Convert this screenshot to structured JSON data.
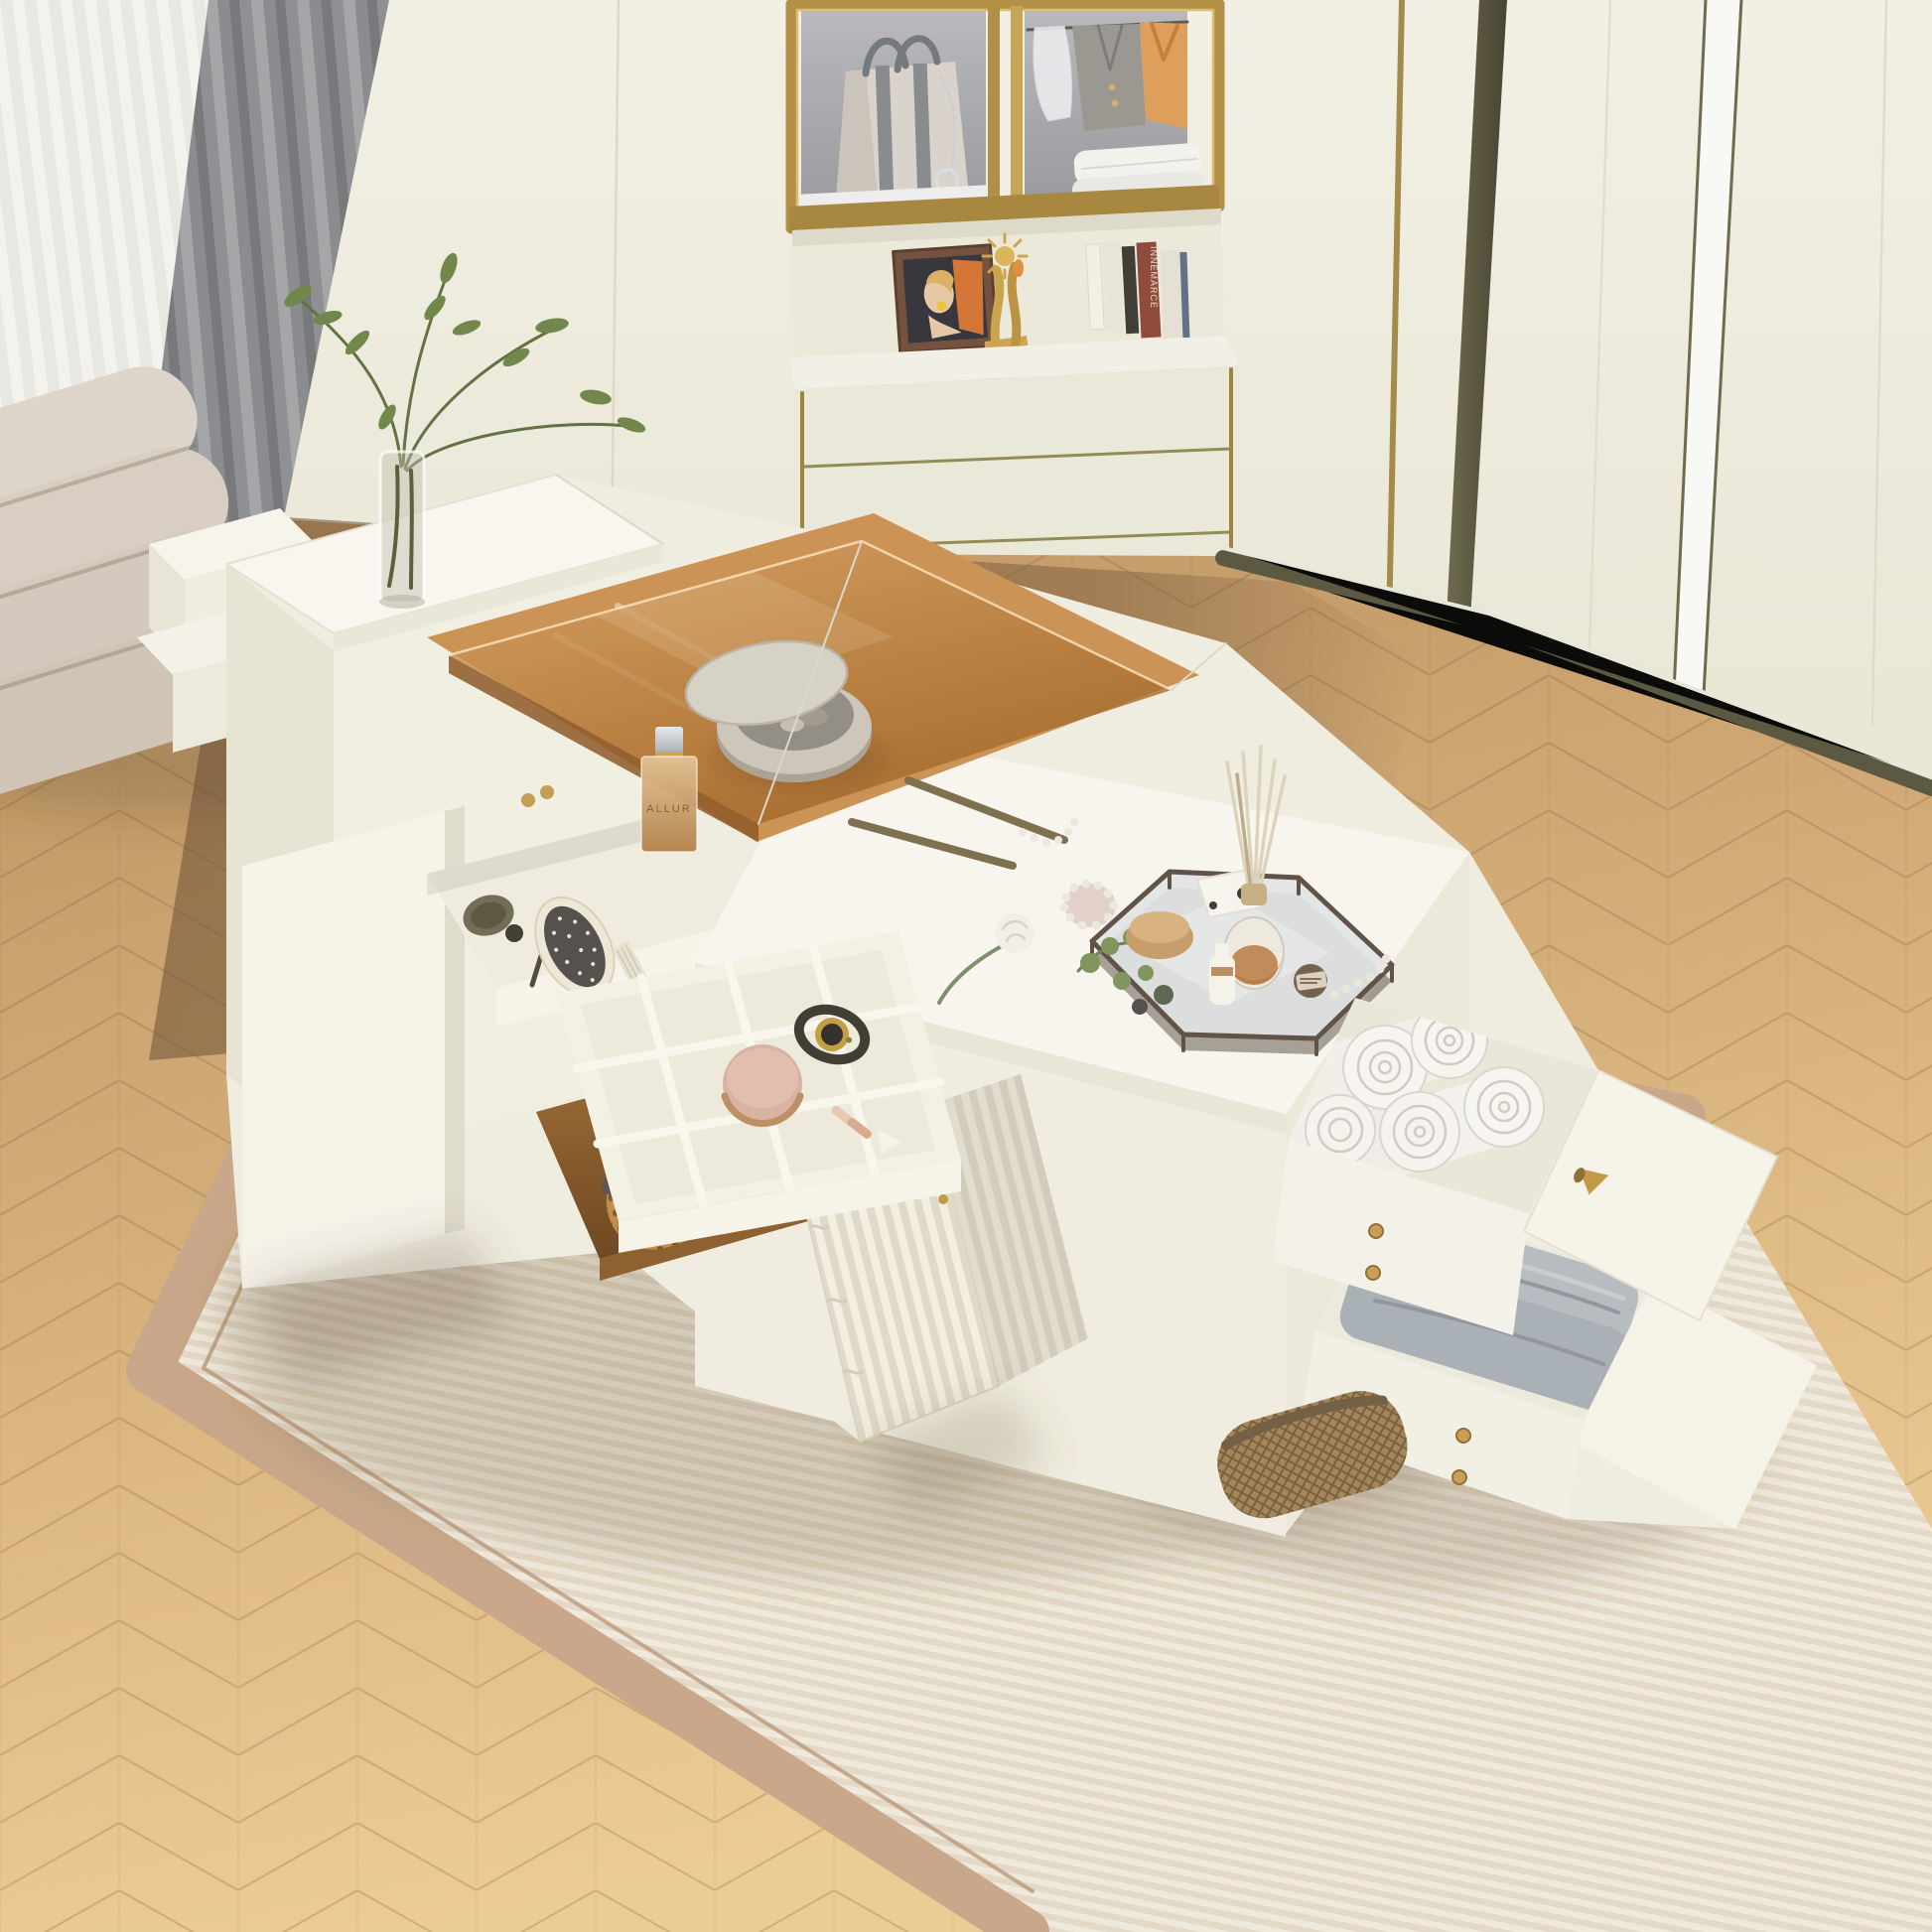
{
  "texts": {
    "perfume_label": "ALLUR",
    "book_spine": "INNEMARCE"
  },
  "palette": {
    "wall_cream": "#f0eee1",
    "trim_gold": "#b08c3e",
    "trim_olive": "#5c5940",
    "cabinet_interior_gray": "#a9a9ae",
    "floor_oak": "#dcb67e",
    "floor_walnut": "#7b5c3e",
    "rug_border_tan": "#c7a486",
    "rug_field_cream": "#eae2d2",
    "curtain_gray": "#8e9093",
    "sheer_white": "#eceae4",
    "bench_beige": "#d6ccc0",
    "island_white": "#f2efe4",
    "amber_glass": "#b97c3d",
    "rattan": "#bb833f",
    "towel_white": "#f4f2ee",
    "towel_gray": "#afb5bb",
    "knob_gold": "#c29540",
    "watch_gold": "#c09b3b",
    "powder_pink": "#d7b09e",
    "leaf_green": "#6b7d52"
  },
  "objects": [
    "wardrobe-wall",
    "display-cabinet",
    "striped-tote-bag",
    "hanging-clothes",
    "folded-shirts",
    "portrait-frame",
    "gold-trophy",
    "books",
    "lower-chest-drawers",
    "gray-curtain",
    "sheer-curtain",
    "upholstered-bench",
    "chevron-wood-floor",
    "striped-area-rug",
    "storage-island",
    "glass-vase-with-branches",
    "perfume-bottle",
    "stone-trinket-dish",
    "jewelry-organizer-grid",
    "wristwatch",
    "powder-compact",
    "paddle-hairbrush",
    "makeup-brush",
    "pocket-comb",
    "hexagonal-mirror-tray",
    "reed-diffuser",
    "eucalyptus-sprigs",
    "white-rose",
    "pearl-accessories",
    "rolled-white-towels",
    "folded-gray-towels",
    "rattan-basket",
    "wicker-basket",
    "fluted-cabinet-door",
    "open-left-door",
    "pulled-out-drawers"
  ]
}
